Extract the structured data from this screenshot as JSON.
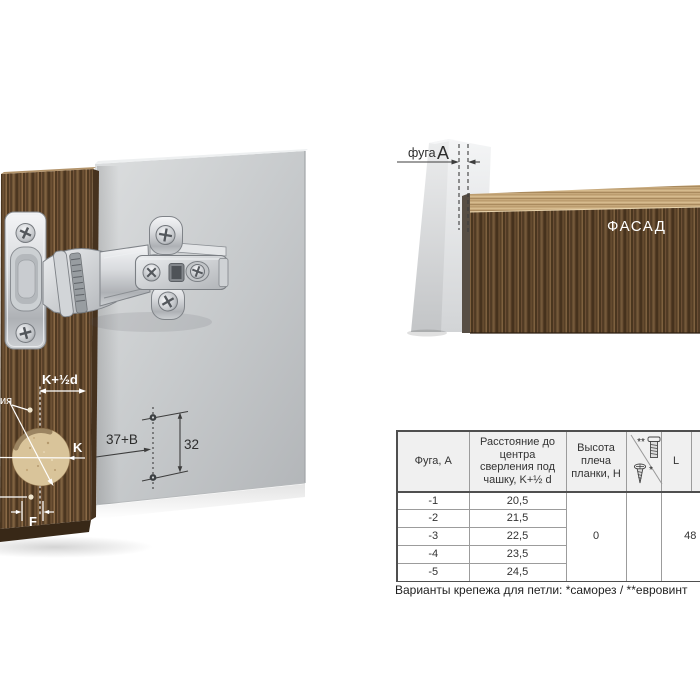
{
  "page": {
    "background": "#ffffff"
  },
  "illustration": {
    "labels": {
      "cup_offset": "K+½d",
      "cup_to_edge": "K",
      "edge_gap": "F",
      "axis_label_partial": "ия",
      "plate_setback": "37+B",
      "system_pitch": "32"
    }
  },
  "corner_diagram": {
    "gap_word": "фуга",
    "gap_param": "A",
    "facade_label": "ФАСАД"
  },
  "spec_table": {
    "headers": {
      "fuga": "Фуга, А",
      "distance": "Расстояние до центра сверления под чашку, K+½ d",
      "shoulder": "Высота плеча планки, H",
      "fastener_euro_mark": "**",
      "fastener_self_mark": "*",
      "length": "L"
    },
    "rows": [
      {
        "fuga": "-1",
        "distance": "20,5"
      },
      {
        "fuga": "-2",
        "distance": "21,5"
      },
      {
        "fuga": "-3",
        "distance": "22,5"
      },
      {
        "fuga": "-4",
        "distance": "23,5"
      },
      {
        "fuga": "-5",
        "distance": "24,5"
      }
    ],
    "shoulder_height_value": "0",
    "length_value": "48"
  },
  "caption": "Варианты крепежа для петли: *саморез / **евровинт",
  "colors": {
    "panel_gray": "#c6c9cb",
    "wood_dark": "#5d442a",
    "wood_light": "#c7a97c",
    "annotation_white": "#ffffff",
    "annotation_dark": "#3d3d3d",
    "table_border": "#4f4f4f",
    "header_bg": "#f0f0f0"
  }
}
